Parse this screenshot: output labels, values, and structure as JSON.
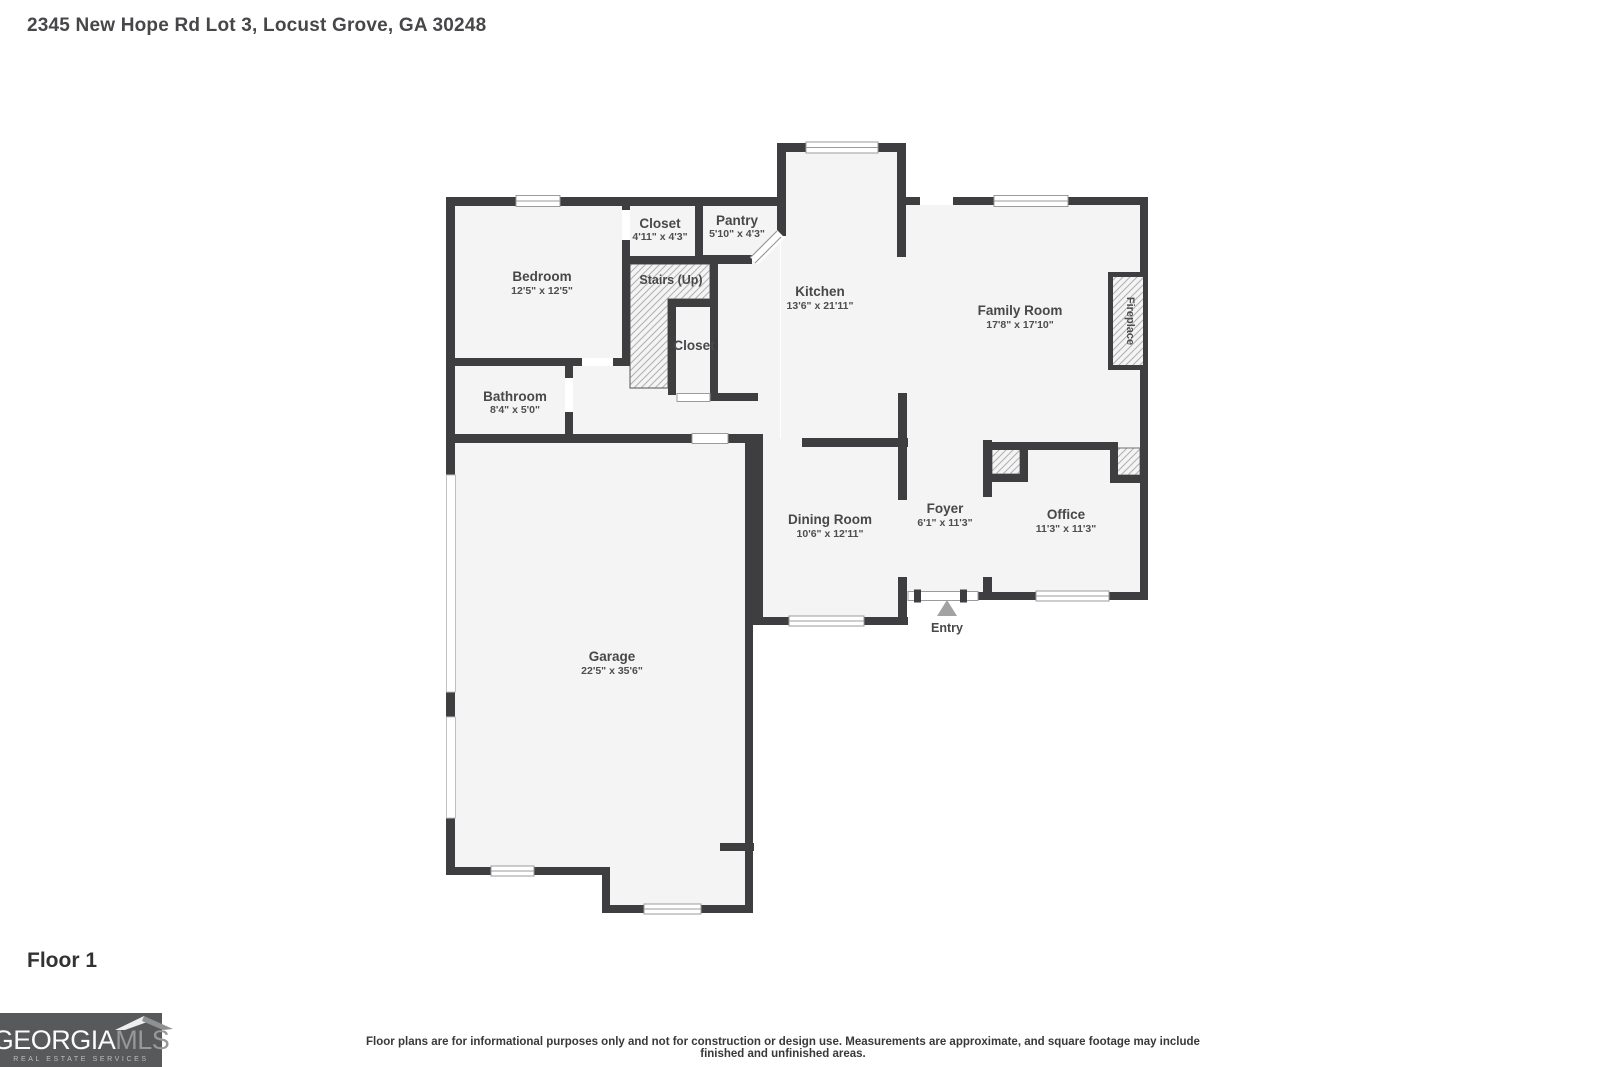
{
  "page": {
    "title": "2345 New Hope Rd Lot 3, Locust Grove, GA 30248",
    "floor_label": "Floor 1",
    "disclaimer": "Floor plans are for informational purposes only and not for construction or design use. Measurements are approximate, and square footage may include finished and unfinished areas."
  },
  "logo": {
    "brand_primary": "GEORGIA",
    "brand_secondary": "MLS",
    "tagline": "REAL ESTATE SERVICES"
  },
  "floorplan": {
    "rooms": {
      "bedroom": {
        "name": "Bedroom",
        "dims": "12'5\" x 12'5\""
      },
      "closet_top": {
        "name": "Closet",
        "dims": "4'11\" x 4'3\""
      },
      "pantry": {
        "name": "Pantry",
        "dims": "5'10\" x 4'3\""
      },
      "stairs": {
        "name": "Stairs (Up)"
      },
      "kitchen": {
        "name": "Kitchen",
        "dims": "13'6\" x 21'11\""
      },
      "closet_lower": {
        "name": "Closet"
      },
      "family_room": {
        "name": "Family Room",
        "dims": "17'8\" x 17'10\""
      },
      "fireplace": {
        "name": "Fireplace"
      },
      "bathroom": {
        "name": "Bathroom",
        "dims": "8'4\" x 5'0\""
      },
      "dining_room": {
        "name": "Dining Room",
        "dims": "10'6\" x 12'11\""
      },
      "foyer": {
        "name": "Foyer",
        "dims": "6'1\" x 11'3\""
      },
      "office": {
        "name": "Office",
        "dims": "11'3\" x 11'3\""
      },
      "garage": {
        "name": "Garage",
        "dims": "22'5\" x 35'6\""
      },
      "entry": {
        "name": "Entry"
      }
    },
    "colors": {
      "wall": "#3e3e40",
      "floor": "#f4f4f4",
      "hatch_line": "#b2b2b2",
      "label": "#48484a",
      "entry_arrow": "#a2a2a2",
      "logo_background": "#58595b"
    }
  }
}
